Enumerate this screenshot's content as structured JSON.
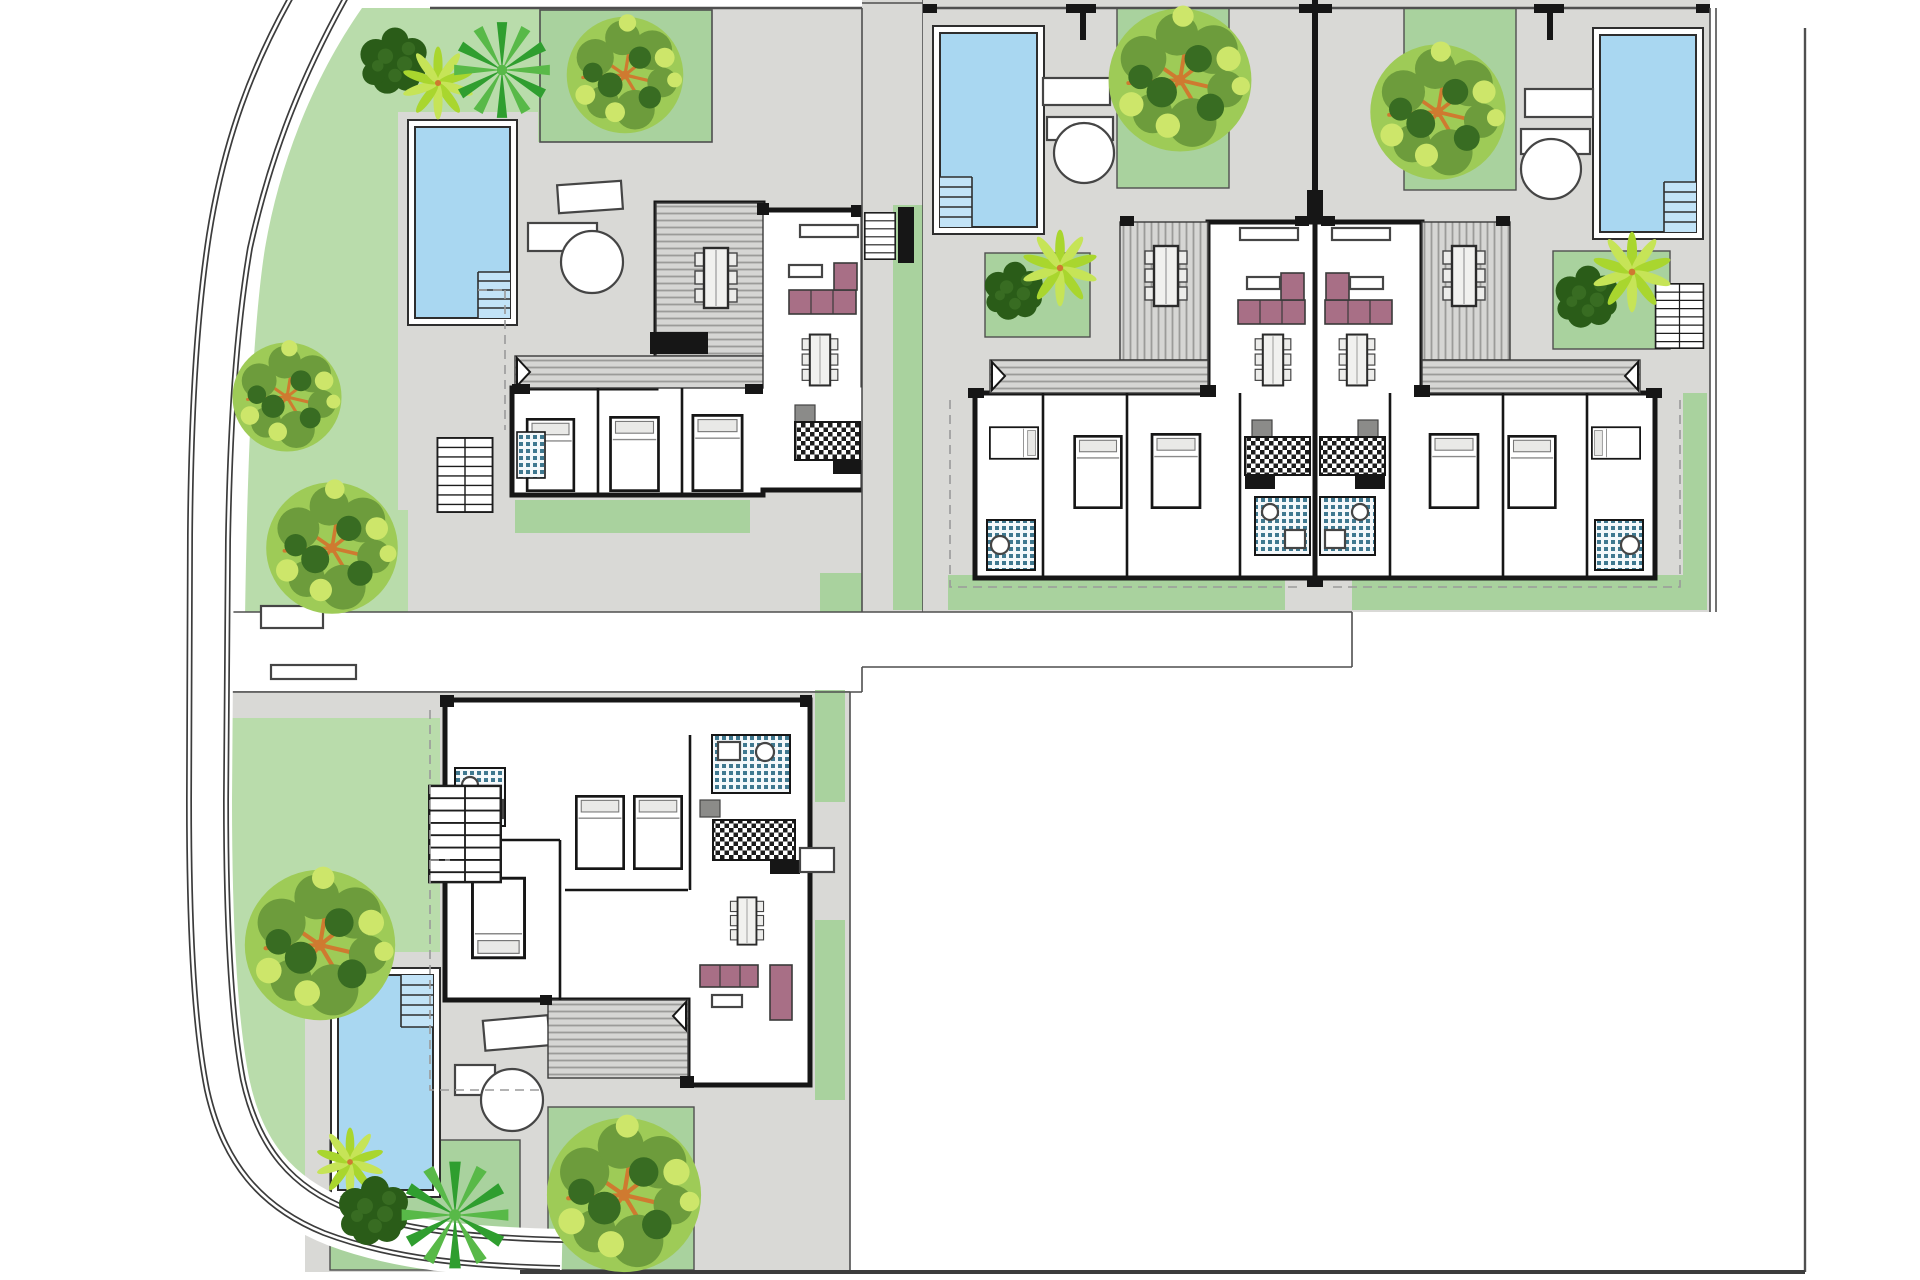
{
  "palette": {
    "background": "#ffffff",
    "lawn": "#b9dcab",
    "lawn_square": "#a9d29e",
    "paving": "#d9d9d6",
    "pool_water": "#a9d7f1",
    "pool_water_light": "#c2e3f7",
    "pool_rim": "#ffffff",
    "wall": "#161616",
    "outline": "#2e2e2e",
    "boundary": "#4f4f4f",
    "road_line": "#3c3c3c",
    "deck_base": "#d6d6d4",
    "deck_stripe": "#9b9b99",
    "sofa": "#a86f86",
    "bath_tile": "#3f788f",
    "furniture_outline": "#454545",
    "tree_bright": "#9ecb57",
    "tree_mid": "#6d9c3c",
    "tree_dark": "#386c22",
    "tree_darkest": "#2a5c18",
    "tree_highlight": "#cde66a",
    "palm_green": "#2f9e2f",
    "palm_light": "#58b948",
    "star_palm": "#a9d62e",
    "star_palm_light": "#c6e457",
    "branch_orange": "#cf7a30"
  },
  "scene": {
    "type": "architectural-site-plan",
    "description": "Ground-floor site plan of a small residential development: three buildings (four villa units) with private pools, timber deck terraces, lawned gardens, trees and a curved perimeter road on the left and bottom.",
    "road": {
      "style": "curved double-line perimeter road",
      "position": "left edge curving along the bottom"
    },
    "plots": [
      {
        "name": "villa-plot-northwest",
        "pool": "rectangular pool with internal corner steps",
        "furniture": [
          "sun-lounger",
          "side-table",
          "round-table"
        ],
        "rooms": [
          "living-room",
          "deck-terrace-with-dining-table",
          "kitchen",
          "3-bedrooms",
          "2-bathrooms"
        ],
        "garden": [
          "lawn",
          "dark-tree",
          "star-palm",
          "fan-palm",
          "large-round-tree",
          "lawn-square-with-tree"
        ],
        "stairs": [
          "external-staircase",
          "entry-steps"
        ]
      },
      {
        "name": "semi-detached-unit-west",
        "pool": "rectangular pool with internal corner steps",
        "furniture": [
          "sun-lounger",
          "side-table",
          "round-table"
        ],
        "rooms": [
          "living-room",
          "deck-terrace-with-dining-table",
          "kitchen",
          "3-bedrooms",
          "2-bathrooms"
        ],
        "garden": [
          "lawn-square-with-tree",
          "courtyard-shrub-and-palm",
          "rear-lawn-strip"
        ]
      },
      {
        "name": "semi-detached-unit-east",
        "pool": "rectangular pool with internal corner steps",
        "furniture": [
          "sun-lounger",
          "side-table",
          "round-table"
        ],
        "rooms": [
          "living-room",
          "deck-terrace-with-dining-table",
          "kitchen",
          "3-bedrooms",
          "2-bathrooms"
        ],
        "garden": [
          "lawn-square-with-tree",
          "palm-group-square",
          "rear-lawn-strip"
        ],
        "stairs": [
          "external-staircase"
        ]
      },
      {
        "name": "villa-plot-south",
        "pool": "rectangular pool with internal corner steps",
        "furniture": [
          "sun-lounger",
          "side-table",
          "round-table"
        ],
        "rooms": [
          "living-room",
          "deck-terrace-with-dining-table",
          "kitchen",
          "3-bedrooms",
          "2-bathrooms"
        ],
        "garden": [
          "lawn",
          "large-round-tree",
          "palm-group",
          "lawn-square-with-tree"
        ],
        "stairs": [
          "external-staircase"
        ]
      }
    ],
    "counts": {
      "pools": 4,
      "villa_units": 4,
      "tree_clusters": 13,
      "trees_drawn": 17,
      "sun_loungers": 4,
      "round_tables": 4
    }
  }
}
